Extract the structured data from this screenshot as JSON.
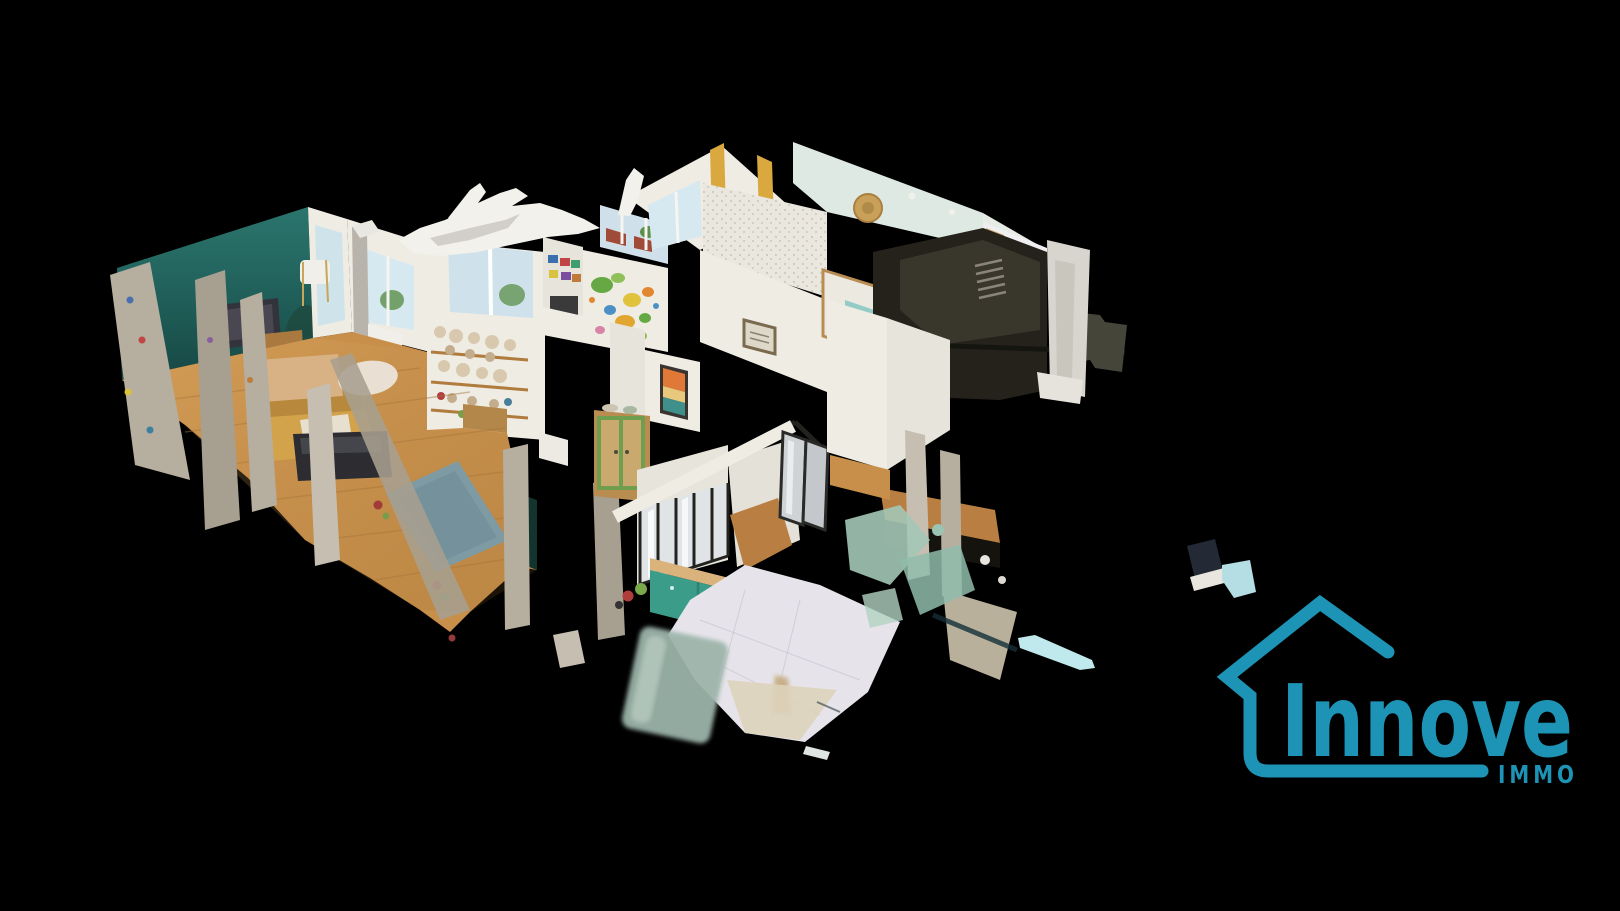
{
  "app": {
    "type": "3d-virtual-tour-viewer",
    "view_mode": "dollhouse",
    "background": "#000000"
  },
  "brand": {
    "name": "Innove",
    "sub": "IMMO",
    "color": "#1d94b6"
  },
  "scene": {
    "description": "Cutaway 3D dollhouse scan of an apartment seen from above at an angle, with photogrammetry artifacts on black background",
    "colors": {
      "background": "#000000",
      "accent_wall": "#2a756d",
      "wood_floor": "#c78f4a",
      "wood_floor_dark": "#b97f42",
      "rug": "#7e9aa3",
      "sofa": "#d3a34c",
      "coffee_table": "#d8b184",
      "tv": "#33333b",
      "kitchen_cabinet": "#3a9c89",
      "counter_wood": "#d9b27c",
      "tile_floor": "#e6e4ea",
      "wall_white": "#efece4",
      "mint_wall": "#dde9e2",
      "sparkle_wall": "#eae7df",
      "dark_room": "#24221b",
      "dark_room_face": "#3c3a2e",
      "curtain": "#d9a83f",
      "frosted_glass": "#9db5ab",
      "window_glass": "#d7e9f0",
      "cabinet_green": "#6f9e4f",
      "artifact_white": "#f2f1ec",
      "fragment_blue": "#b5dde4"
    },
    "rooms": [
      {
        "name": "living-room",
        "features": [
          "teal accent wall",
          "tv",
          "yellow sofa",
          "blue-grey rug",
          "parquet floor",
          "shelf wall with plush toys"
        ]
      },
      {
        "name": "kids-room",
        "features": [
          "world map wall",
          "craft shelves",
          "windows"
        ]
      },
      {
        "name": "bedroom",
        "features": [
          "sparkle wallpaper",
          "yellow curtains",
          "mint walls",
          "wicker wall decor",
          "bed"
        ]
      },
      {
        "name": "kitchen",
        "features": [
          "black framed glass partition",
          "teal cabinets",
          "wood counter",
          "white tile floor",
          "frosted door"
        ]
      },
      {
        "name": "dark-room",
        "features": [
          "unlit scanned room",
          "stair ladder"
        ]
      }
    ]
  }
}
